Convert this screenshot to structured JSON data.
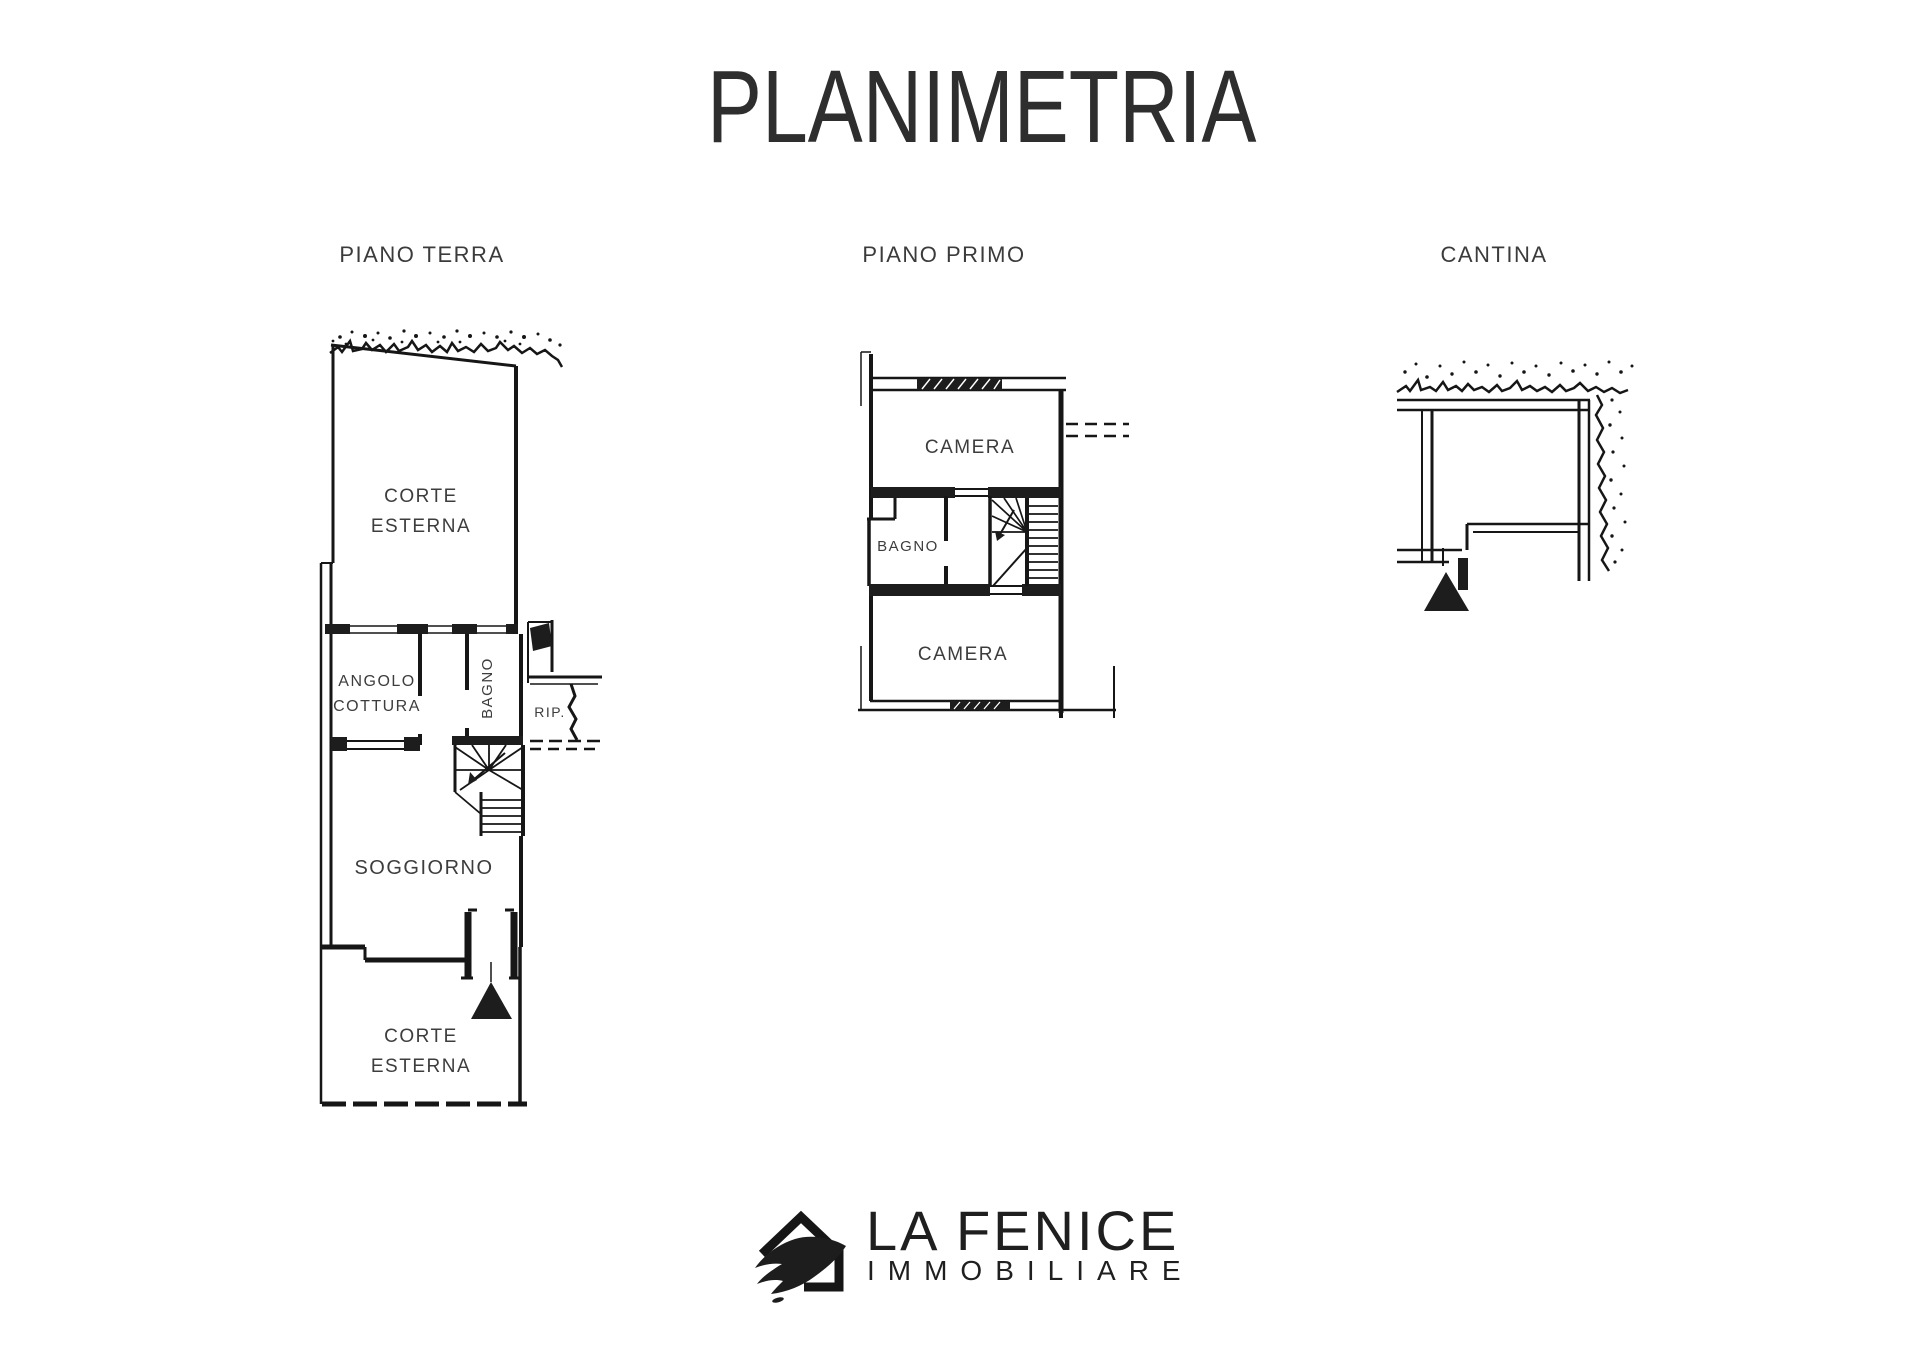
{
  "page": {
    "title": "PLANIMETRIA",
    "background": "#ffffff"
  },
  "colors": {
    "ink": "#161616",
    "room_label": "#3d3d3d",
    "title": "#2e2e2e"
  },
  "floors": {
    "ground": {
      "label": "PIANO TERRA",
      "rooms": {
        "corte_top_1": "CORTE",
        "corte_top_2": "ESTERNA",
        "angolo_1": "ANGOLO",
        "angolo_2": "COTTURA",
        "bagno": "BAGNO",
        "rip": "RIP.",
        "soggiorno": "SOGGIORNO",
        "corte_bottom_1": "CORTE",
        "corte_bottom_2": "ESTERNA"
      }
    },
    "first": {
      "label": "PIANO PRIMO",
      "rooms": {
        "camera_top": "CAMERA",
        "bagno": "BAGNO",
        "camera_bottom": "CAMERA"
      }
    },
    "cellar": {
      "label": "CANTINA"
    }
  },
  "icons": {
    "entrance_marker": "filled-triangle-up",
    "terrain_hatch": "stipple-band",
    "logo_mark": "house-with-phoenix-wing"
  },
  "logo": {
    "line1": "LA FENICE",
    "line2": "IMMOBILIARE"
  }
}
